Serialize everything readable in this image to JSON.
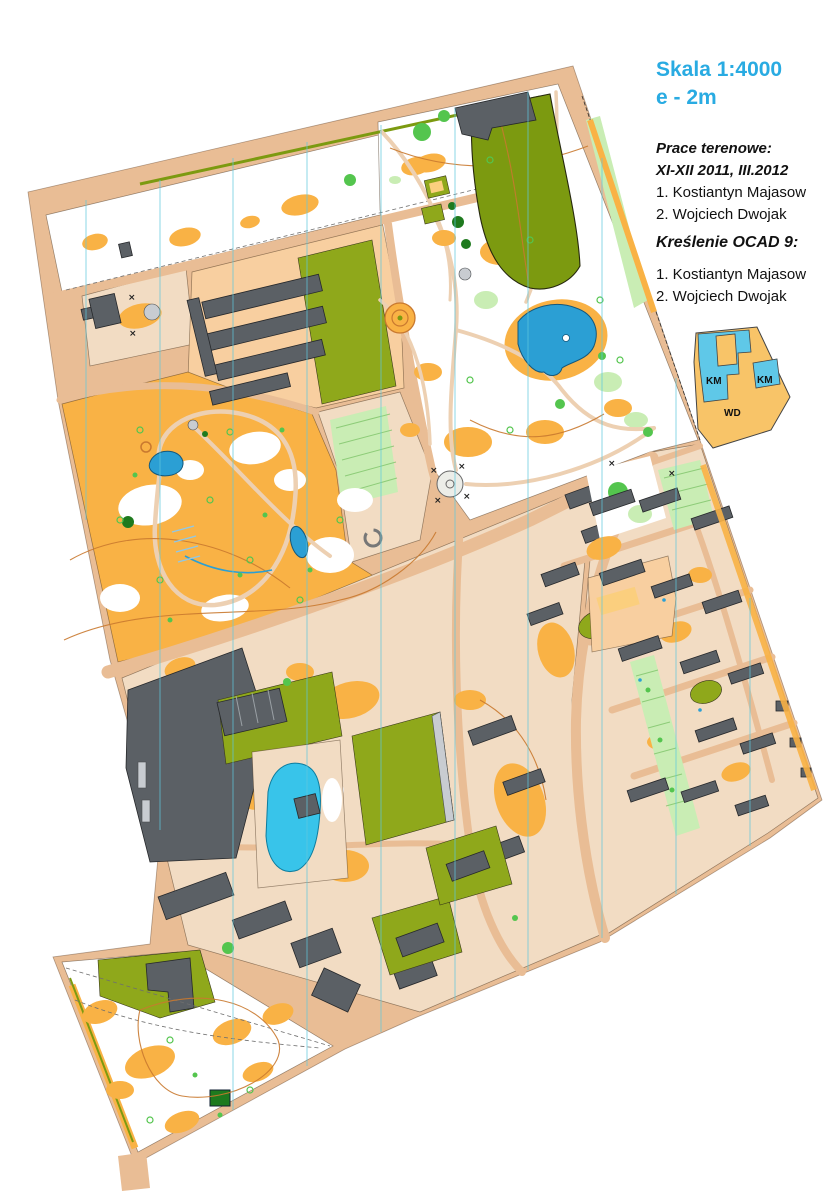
{
  "title": {
    "scale": "Skala 1:4000",
    "contour_interval": "e - 2m"
  },
  "credits": {
    "fieldwork_heading": "Prace terenowe:",
    "fieldwork_dates": "XI-XII 2011, III.2012",
    "fieldwork_authors": [
      "1. Kostiantyn Majasow",
      "2. Wojciech Dwojak"
    ],
    "drawing_heading": "Kreślenie OCAD 9:",
    "drawing_authors": [
      "1. Kostiantyn Majasow",
      "2. Wojciech Dwojak"
    ]
  },
  "legend_diagram": {
    "region_labels": [
      "KM",
      "KM",
      "WD"
    ]
  },
  "palette": {
    "road_tan": "#E9BD95",
    "paved": "#F2DCC3",
    "orange": "#F9B245",
    "orange_light": "#FBCF7E",
    "olive": "#8FA81B",
    "olive_dark": "#7C9A10",
    "green": "#54C54E",
    "green_light": "#C9EDB4",
    "dark_green": "#1E7A1E",
    "building": "#5B6065",
    "gray_light": "#C8CCD1",
    "pond": "#2B9FD4",
    "pool": "#38C4EA",
    "contour": "#C9792F",
    "meridian": "#5FC8DE",
    "path": "#EDD0B2",
    "title_cyan": "#29ABE2",
    "legend_orange": "#F8C468",
    "legend_cyan": "#5FC8E8"
  }
}
